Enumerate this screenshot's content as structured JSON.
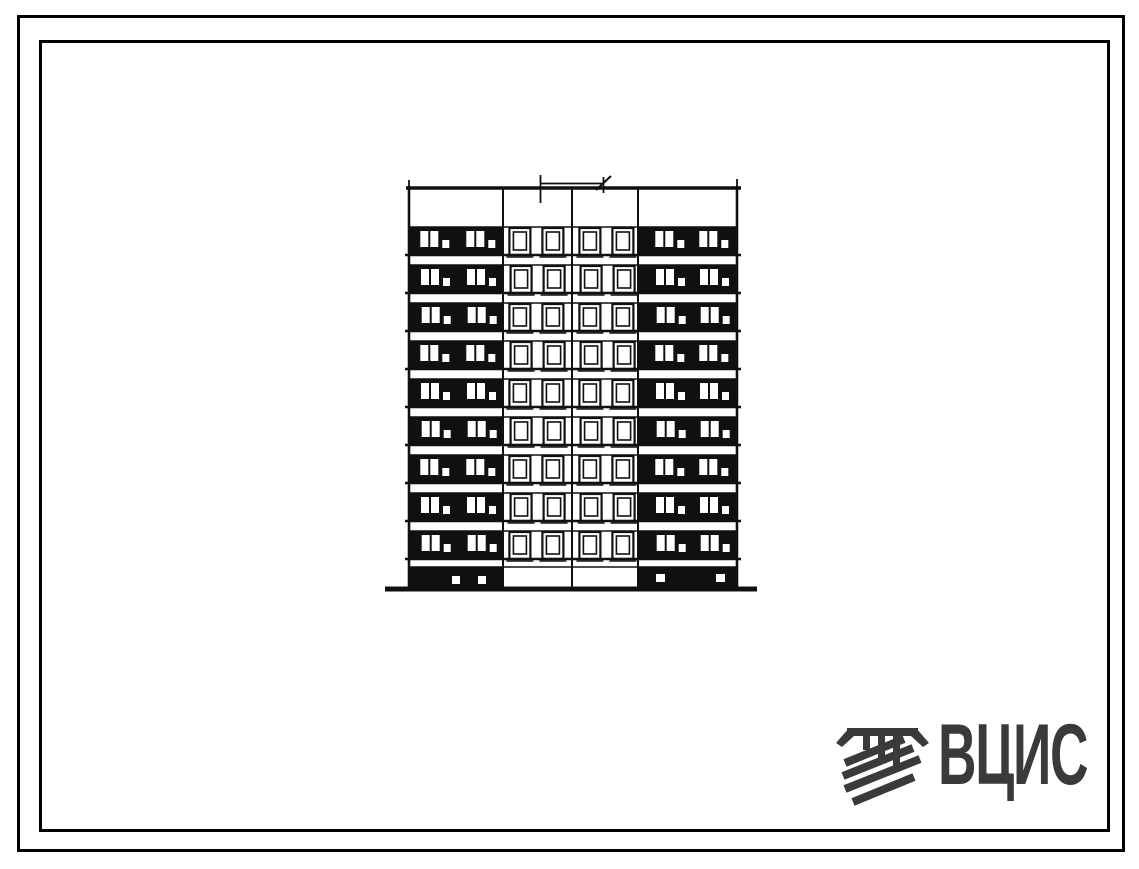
{
  "sheet": {
    "background": "#ffffff",
    "frame_color": "#000000",
    "ink_color": "#101010"
  },
  "logo": {
    "text": "ВЦИС",
    "color": "#3a3a3c",
    "icon": "striped-builder-emblem-icon"
  },
  "drawing": {
    "type": "architectural-elevation",
    "subject": "nine-storey large-panel apartment block facade, hand-drawn",
    "floors": 9,
    "floor_first_band_top": 227,
    "floor_pitch": 38,
    "band_height": 28,
    "building": {
      "left": 409,
      "right": 737,
      "roof_y": 188,
      "parapet_bottom": 227,
      "ground_y": 589,
      "ground_x1": 385,
      "ground_x2": 757
    },
    "section_dividers": [
      503,
      572,
      638
    ],
    "sections": [
      {
        "name": "left-balcony-bay",
        "x1": 409,
        "x2": 503,
        "kind": "balcony",
        "panes": [
          12,
          22
        ],
        "vent1": 34,
        "panes2": [
          58,
          68
        ],
        "vent2": 80
      },
      {
        "name": "left-window-bay",
        "x1": 503,
        "x2": 572,
        "kind": "window",
        "windows": [
          7,
          40
        ],
        "window_w": 21
      },
      {
        "name": "right-window-bay",
        "x1": 572,
        "x2": 638,
        "kind": "window",
        "windows": [
          8,
          41
        ],
        "window_w": 21
      },
      {
        "name": "right-balcony-bay",
        "x1": 638,
        "x2": 737,
        "kind": "balcony",
        "panes": [
          18,
          28
        ],
        "vent1": 40,
        "panes2": [
          62,
          72
        ],
        "vent2": 84
      }
    ],
    "basement": {
      "top": 567,
      "bottom": 588,
      "hatches": [
        {
          "x": 452,
          "y": 576,
          "w": 8,
          "h": 8
        },
        {
          "x": 478,
          "y": 576,
          "w": 8,
          "h": 8
        },
        {
          "x": 656,
          "y": 574,
          "w": 9,
          "h": 8
        },
        {
          "x": 716,
          "y": 574,
          "w": 9,
          "h": 8
        }
      ]
    },
    "dimension_mark": {
      "x1": 540,
      "x2": 604,
      "y": 183.5
    }
  }
}
